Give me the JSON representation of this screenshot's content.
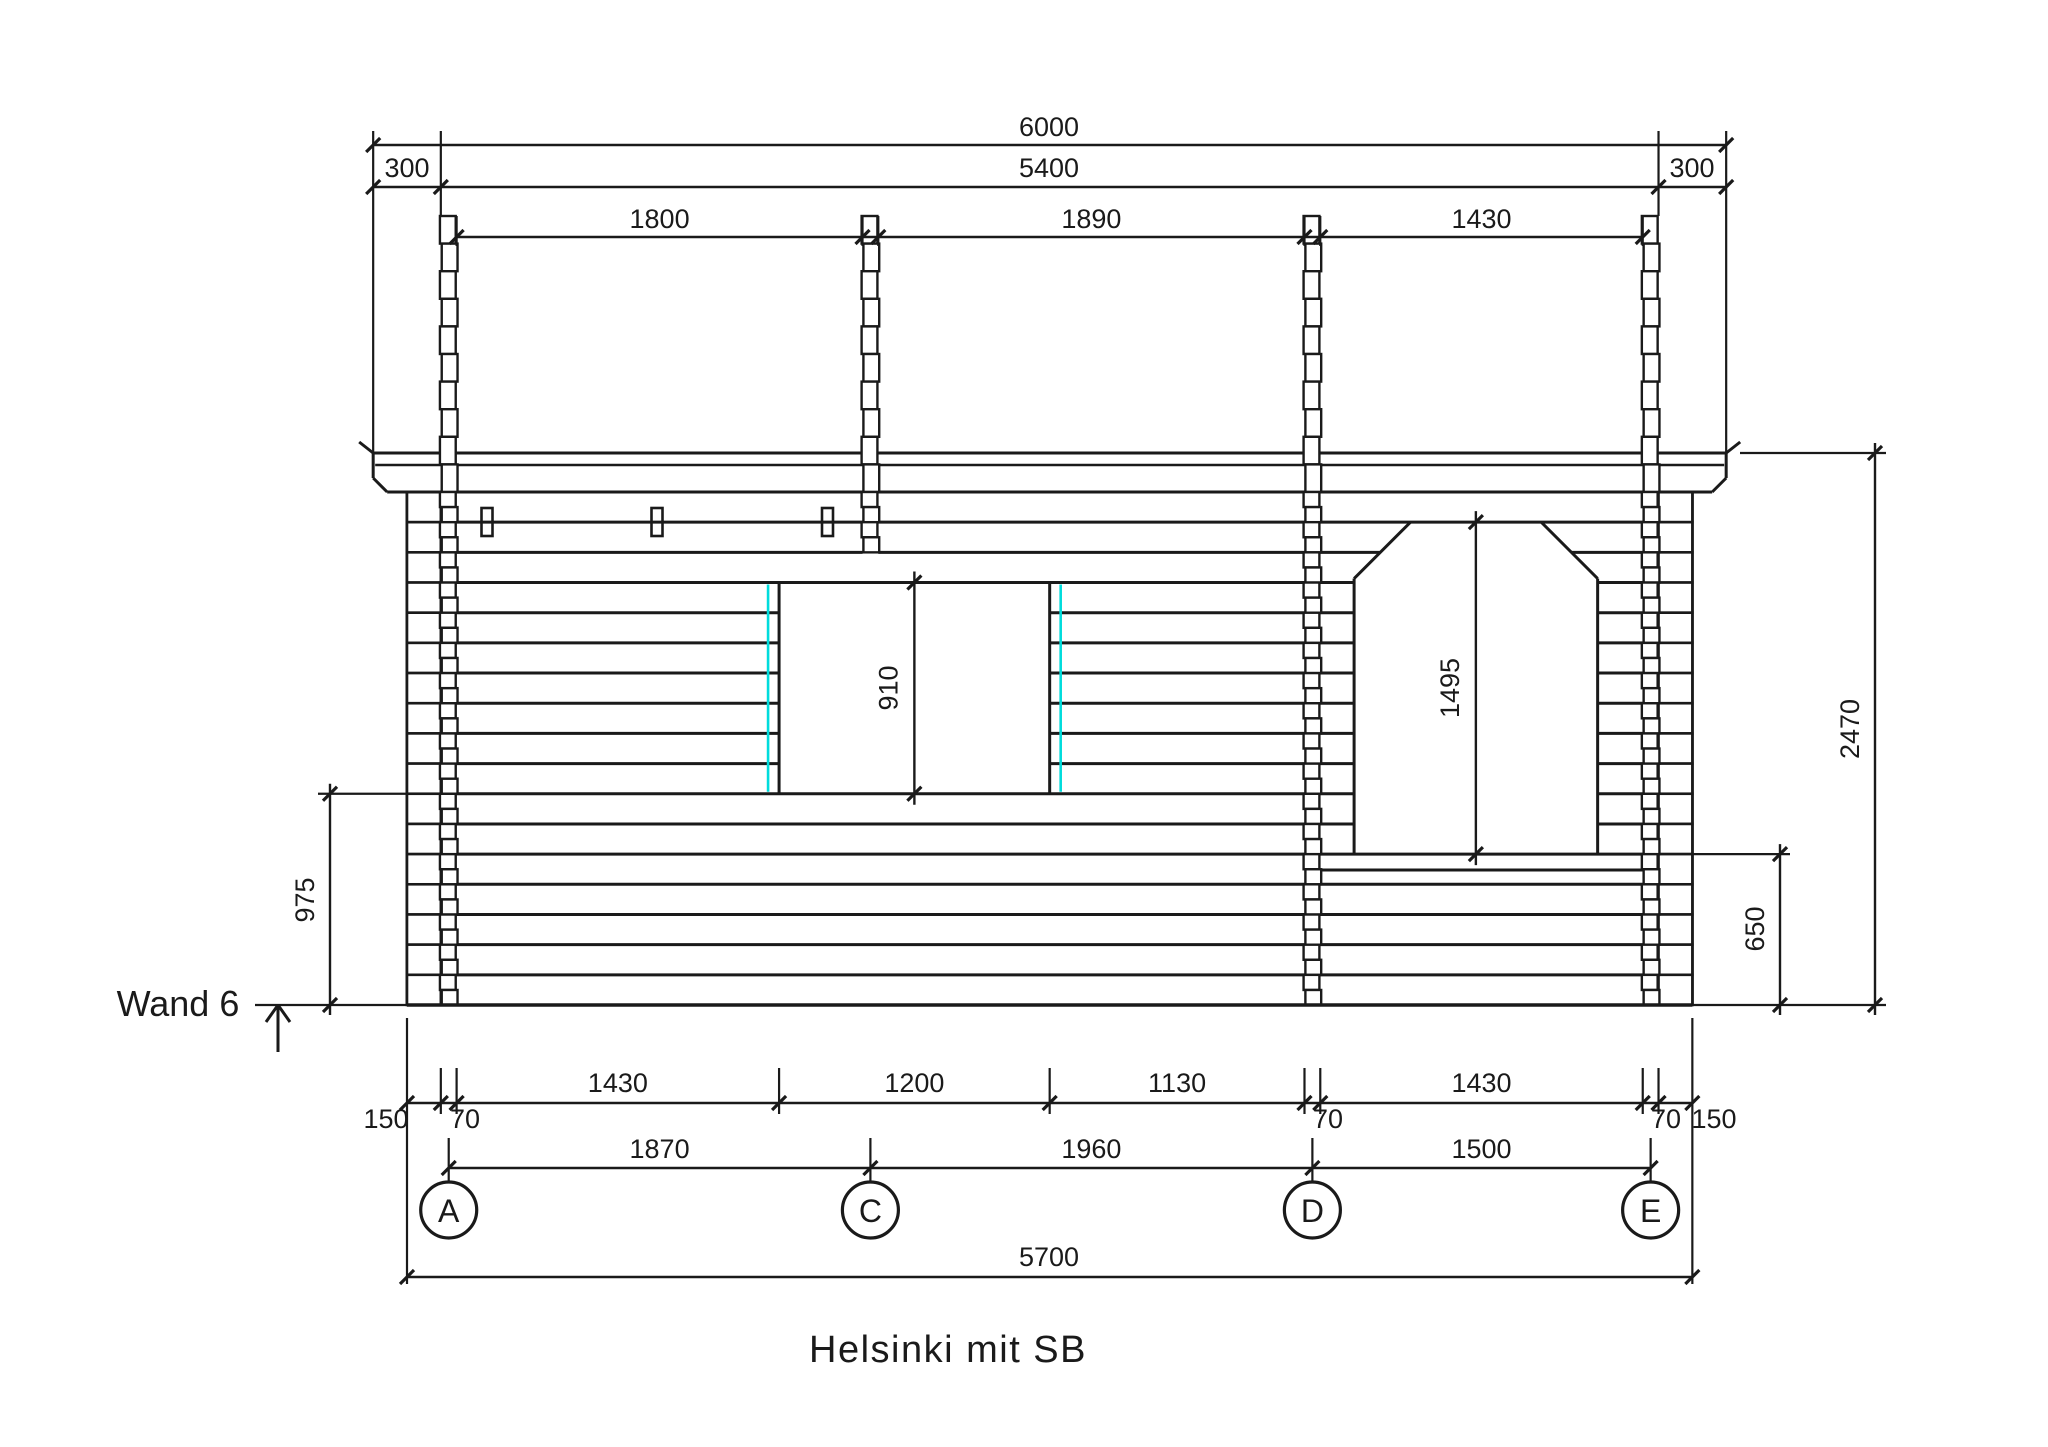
{
  "title": "Helsinki mit SB",
  "wall_label": "Wand 6",
  "colors": {
    "line": "#1a1a1a",
    "accent_cyan": "#00dcdc",
    "background": "#ffffff"
  },
  "axes": [
    "A",
    "C",
    "D",
    "E"
  ],
  "dims": {
    "top_total": "6000",
    "top_left_overhang": "300",
    "top_wall": "5400",
    "top_right_overhang": "300",
    "bay_ac": "1800",
    "bay_cd": "1890",
    "bay_de": "1430",
    "window_height": "910",
    "door_height": "1495",
    "sill_height": "975",
    "door_sill": "650",
    "wall_height": "2470",
    "bottom_row1": [
      "150",
      "70",
      "1430",
      "1200",
      "1130",
      "70",
      "1430",
      "70",
      "150"
    ],
    "bottom_row2": [
      "1870",
      "1960",
      "1500"
    ],
    "bottom_total": "5700"
  }
}
